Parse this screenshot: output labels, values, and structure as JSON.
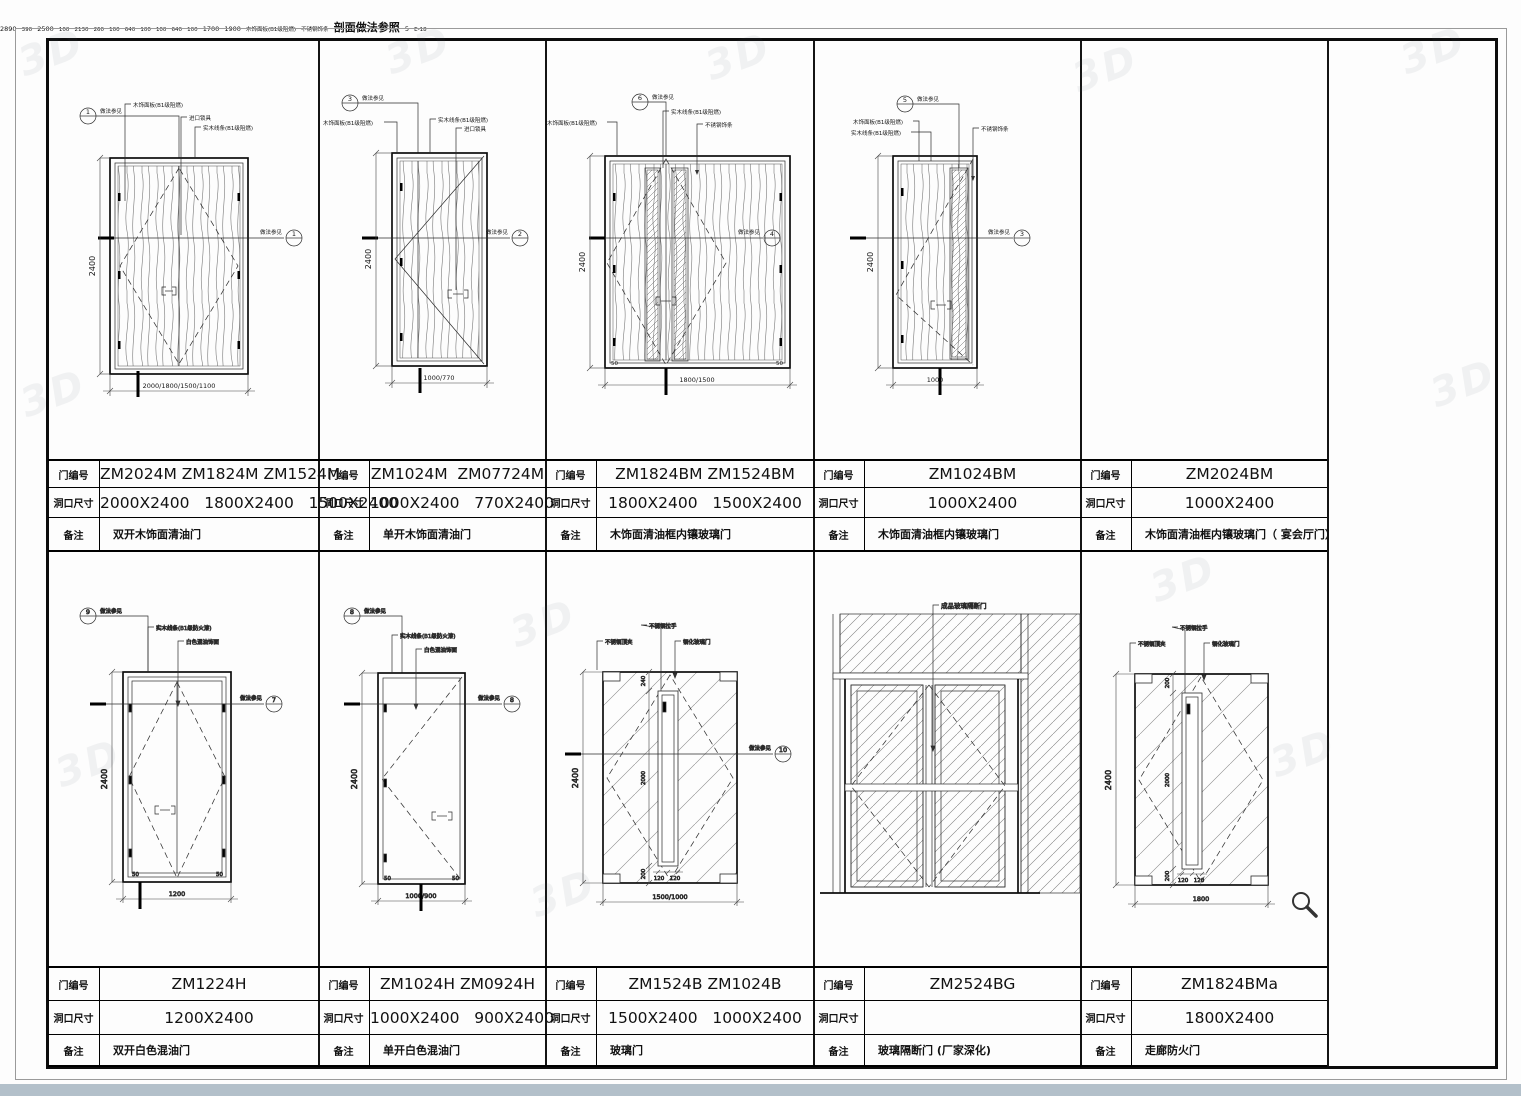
{
  "labels": {
    "door_no": "门编号",
    "opening": "洞口尺寸",
    "remark": "备注"
  },
  "ref_note": "做法参见",
  "watermark": "3D",
  "tables": [
    {
      "no": "ZM2024M ZM1824M ZM1524M",
      "size": "2000X2400   1800X2400   1500X2400",
      "remark": "双开木饰面清油门"
    },
    {
      "no": "ZM1024M  ZM07724M",
      "size": "1000X2400   770X2400",
      "remark": "单开木饰面清油门"
    },
    {
      "no": "ZM1824BM ZM1524BM",
      "size": "1800X2400   1500X2400",
      "remark": "木饰面清油框内镶玻璃门"
    },
    {
      "no": "ZM1024BM",
      "size": "1000X2400",
      "remark": "木饰面清油框内镶玻璃门"
    },
    {
      "no": "ZM2024BM",
      "size": "1000X2400",
      "remark": "木饰面清油框内镶玻璃门（ 宴会厅门）"
    },
    {
      "no": "ZM1224H",
      "size": "1200X2400",
      "remark": "双开白色混油门"
    },
    {
      "no": "ZM1024H ZM0924H",
      "size": "1000X2400   900X2400",
      "remark": "单开白色混油门"
    },
    {
      "no": "ZM1524B ZM1024B",
      "size": "1500X2400   1000X2400",
      "remark": "玻璃门"
    },
    {
      "no": "ZM2524BG",
      "size": "",
      "remark": "玻璃隔断门 (厂家深化)"
    },
    {
      "no": "ZM1824BMa",
      "size": "1800X2400",
      "remark": "走廊防火门"
    }
  ],
  "drawings": {
    "d1": {
      "height": "2400",
      "width": "2000/1800/1500/1100",
      "l1": "木饰面板(B1级阻燃)",
      "l2": "进口锁具",
      "l3": "实木线条(B1级阻燃)",
      "ref_top": "1",
      "ref_mid": "1"
    },
    "d2": {
      "height": "2400",
      "width": "1000/770",
      "l1": "木饰面板(B1级阻燃)",
      "l2": "实木线条(B1级阻燃)",
      "l3": "进口锁具",
      "ref_top": "3",
      "ref_mid": "2"
    },
    "d3": {
      "height": "2400",
      "width": "1800/1500",
      "corner": "50",
      "l1": "木饰面板(B1级阻燃)",
      "l2": "实木线条(B1级阻燃)",
      "l3": "不锈钢饰条",
      "ref_top": "6",
      "ref_mid": "4"
    },
    "d4": {
      "height": "2400",
      "width": "1000",
      "l1": "木饰面板(B1级阻燃)",
      "l2": "实木线条(B1级阻燃)",
      "l3": "不锈钢饰条",
      "ref_top": "5",
      "ref_mid": "3"
    },
    "d5": {
      "v_total": "2890",
      "v1": "390",
      "v2": "100",
      "v3": "2500",
      "v4": "2130",
      "v5": "260",
      "h": [
        "100",
        "640",
        "100",
        "100",
        "640",
        "100"
      ],
      "w1": "1700",
      "w2": "1900",
      "l1": "木饰面板(B1级阻燃)",
      "l2": "不锈钢饰条",
      "caption": "剖面做法参照",
      "bubble_num": "5",
      "bubble_sheet": "E-18"
    },
    "d6": {
      "height": "2400",
      "width": "1200",
      "corner": "50",
      "l1": "实木线条(B1级防火漆)",
      "l2": "白色混油饰面",
      "ref_top": "9",
      "ref_mid": "7"
    },
    "d7": {
      "height": "2400",
      "width": "1000/900",
      "corner": "50",
      "l1": "实木线条(B1级防火漆)",
      "l2": "白色混油饰面",
      "ref_top": "8",
      "ref_mid": "8"
    },
    "d8": {
      "height": "2400",
      "width": "1500/1000",
      "i1": "240",
      "i2": "2000",
      "i3": "200",
      "i4": "120",
      "l1": "不锈钢顶夹",
      "l2": "不锈钢拉手",
      "l3": "钢化玻璃门",
      "ref_mid": "10"
    },
    "d9": {
      "l1": "成品玻璃隔断门"
    },
    "d10": {
      "height": "2400",
      "width": "1800",
      "i1": "200",
      "i2": "2000",
      "i3": "200",
      "i4": "120",
      "l1": "不锈钢顶夹",
      "l2": "不锈钢拉手",
      "l3": "钢化玻璃门"
    }
  }
}
